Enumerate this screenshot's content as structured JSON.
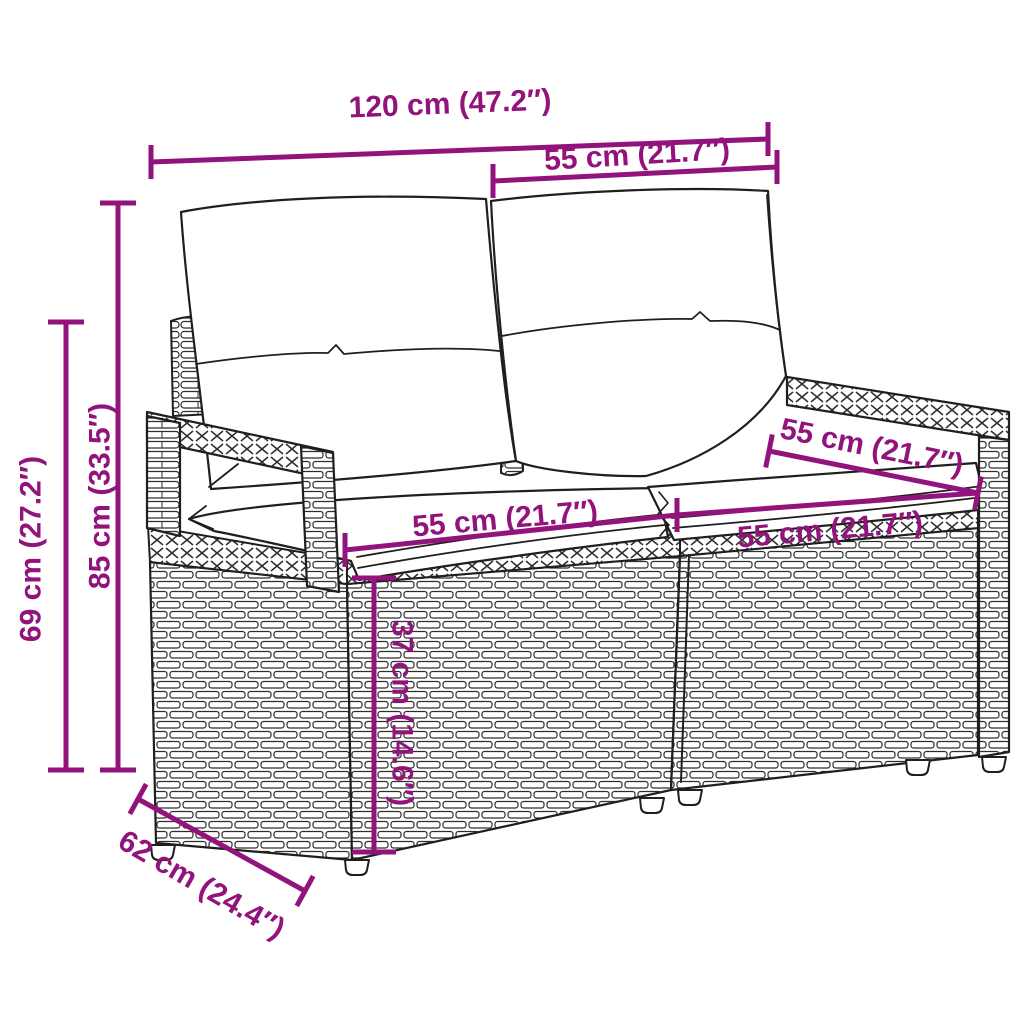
{
  "diagram": {
    "background_color": "#ffffff",
    "accent_color": "#93137D",
    "line_art_color": "#1f1f1f",
    "cushion_color": "#ffffff",
    "measurements": {
      "total_width": "120 cm (47.2″)",
      "backrest_section_width": "55 cm (21.7″)",
      "total_height": "85 cm (33.5″)",
      "armrest_height": "69 cm (27.2″)",
      "seat_left_width": "55 cm (21.7″)",
      "seat_right_width": "55 cm (21.7″)",
      "armrest_depth": "55 cm (21.7″)",
      "seat_height": "37 cm (14.6″)",
      "base_depth": "62 cm (24.4″)"
    }
  }
}
